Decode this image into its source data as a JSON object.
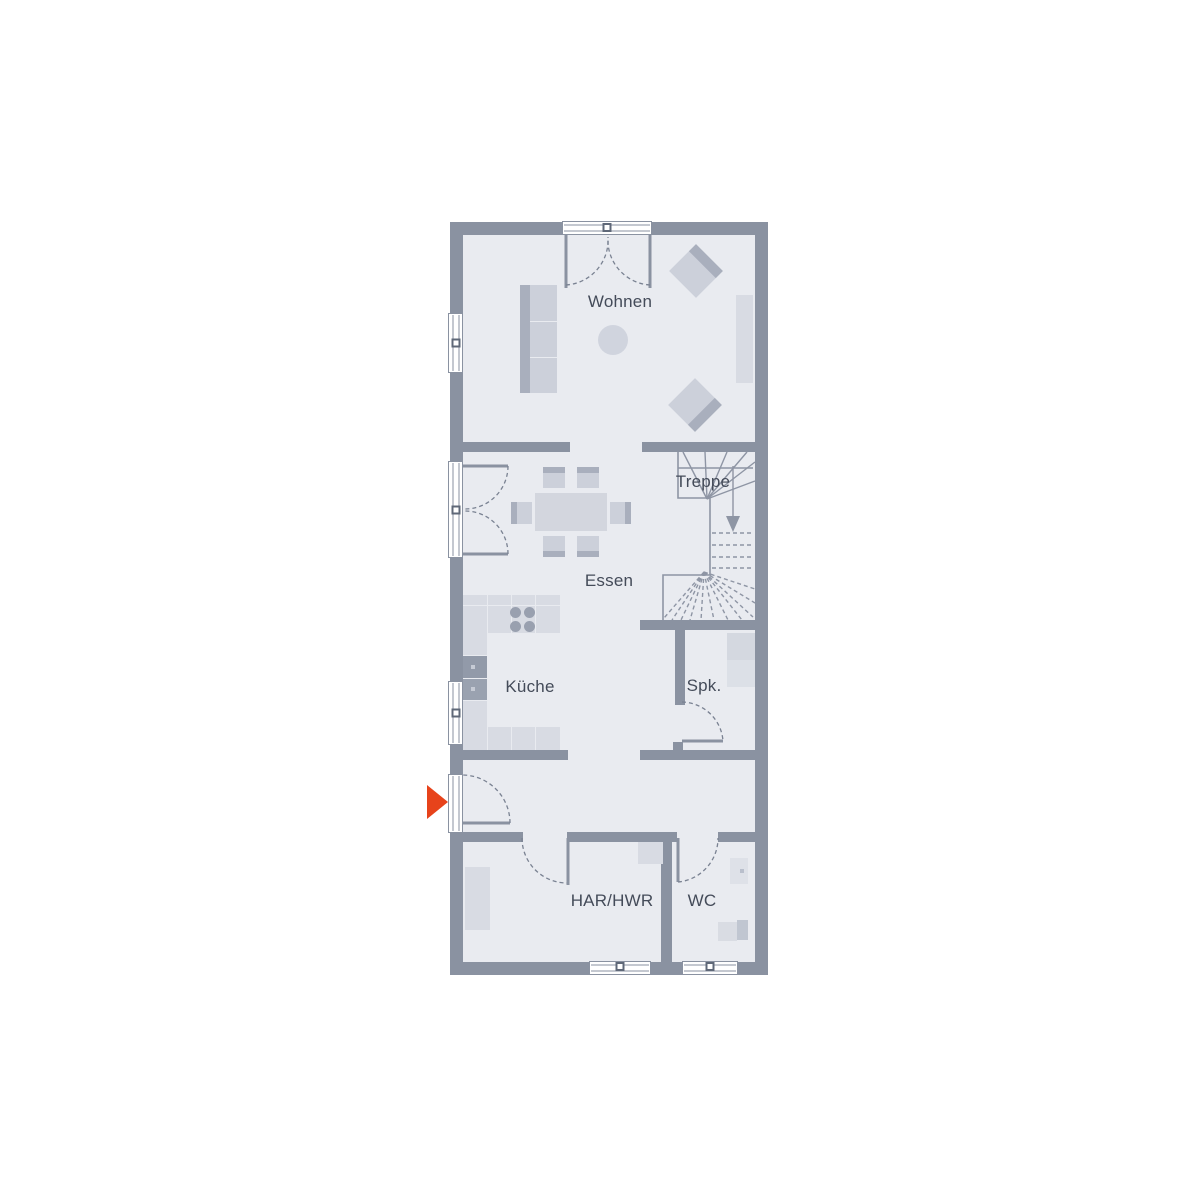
{
  "floor_plan": {
    "labels": {
      "wohnen": "Wohnen",
      "treppe": "Treppe",
      "essen": "Essen",
      "kueche": "Küche",
      "spk": "Spk.",
      "har_hwr": "HAR/HWR",
      "wc": "WC"
    },
    "entrance_marker": {
      "icon": "arrow-right",
      "color": "#e7431b"
    },
    "colors": {
      "wall": "#8a92a1",
      "floor": "#e9ebf0",
      "furniture_light": "#d8dbe3",
      "furniture_mid": "#ccd0da",
      "accent_dark": "#a9afbd",
      "fixture_dark": "#99a0af",
      "entrance_arrow": "#e7431b",
      "label_text": "#444b59",
      "line": "#8e95a4"
    }
  }
}
